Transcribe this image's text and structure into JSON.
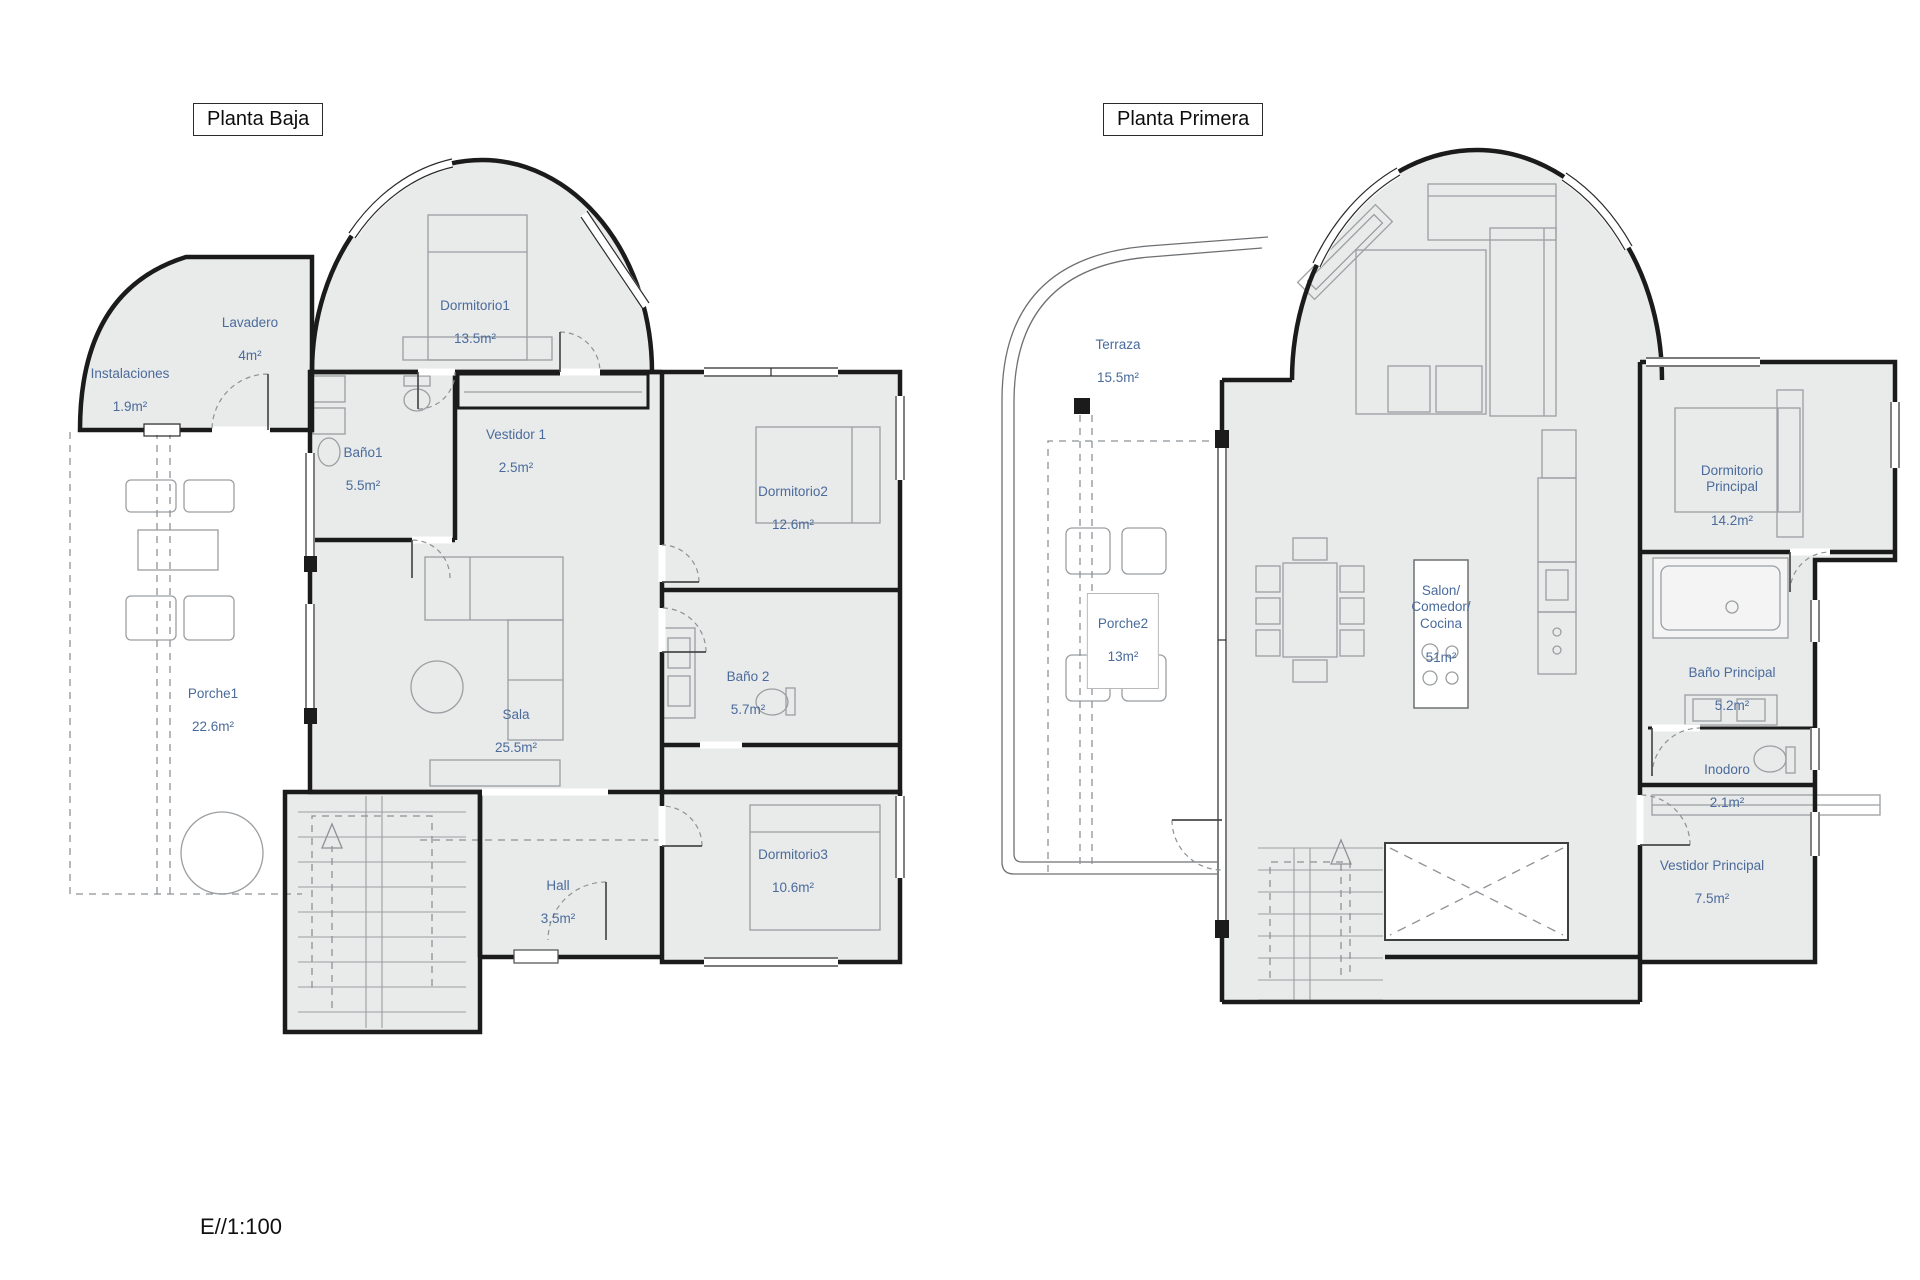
{
  "titles": {
    "left": "Planta Baja",
    "right": "Planta Primera"
  },
  "scale_label": "E//1:100",
  "colors": {
    "label_blue": "#4a6b9c",
    "wall_black": "#1b1b1b",
    "floor_gray": "#e9eaea",
    "furniture_gray": "#9b9fa2"
  },
  "planta_baja": {
    "rooms": [
      {
        "name": "Instalaciones",
        "area": "1.9m²"
      },
      {
        "name": "Lavadero",
        "area": "4m²"
      },
      {
        "name": "Dormitorio1",
        "area": "13.5m²"
      },
      {
        "name": "Baño1",
        "area": "5.5m²"
      },
      {
        "name": "Vestidor 1",
        "area": "2.5m²"
      },
      {
        "name": "Dormitorio2",
        "area": "12.6m²"
      },
      {
        "name": "Sala",
        "area": "25.5m²"
      },
      {
        "name": "Baño 2",
        "area": "5.7m²"
      },
      {
        "name": "Porche1",
        "area": "22.6m²"
      },
      {
        "name": "Dormitorio3",
        "area": "10.6m²"
      },
      {
        "name": "Hall",
        "area": "3.5m²"
      }
    ]
  },
  "planta_primera": {
    "rooms": [
      {
        "name": "Terraza",
        "area": "15.5m²"
      },
      {
        "name": "Porche2",
        "area": "13m²"
      },
      {
        "name": "Salon/\nComedor/\nCocina",
        "area": "51m²"
      },
      {
        "name": "Dormitorio\nPrincipal",
        "area": "14.2m²"
      },
      {
        "name": "Baño Principal",
        "area": "5.2m²"
      },
      {
        "name": "Inodoro",
        "area": "2.1m²"
      },
      {
        "name": "Vestidor Principal",
        "area": "7.5m²"
      }
    ]
  }
}
